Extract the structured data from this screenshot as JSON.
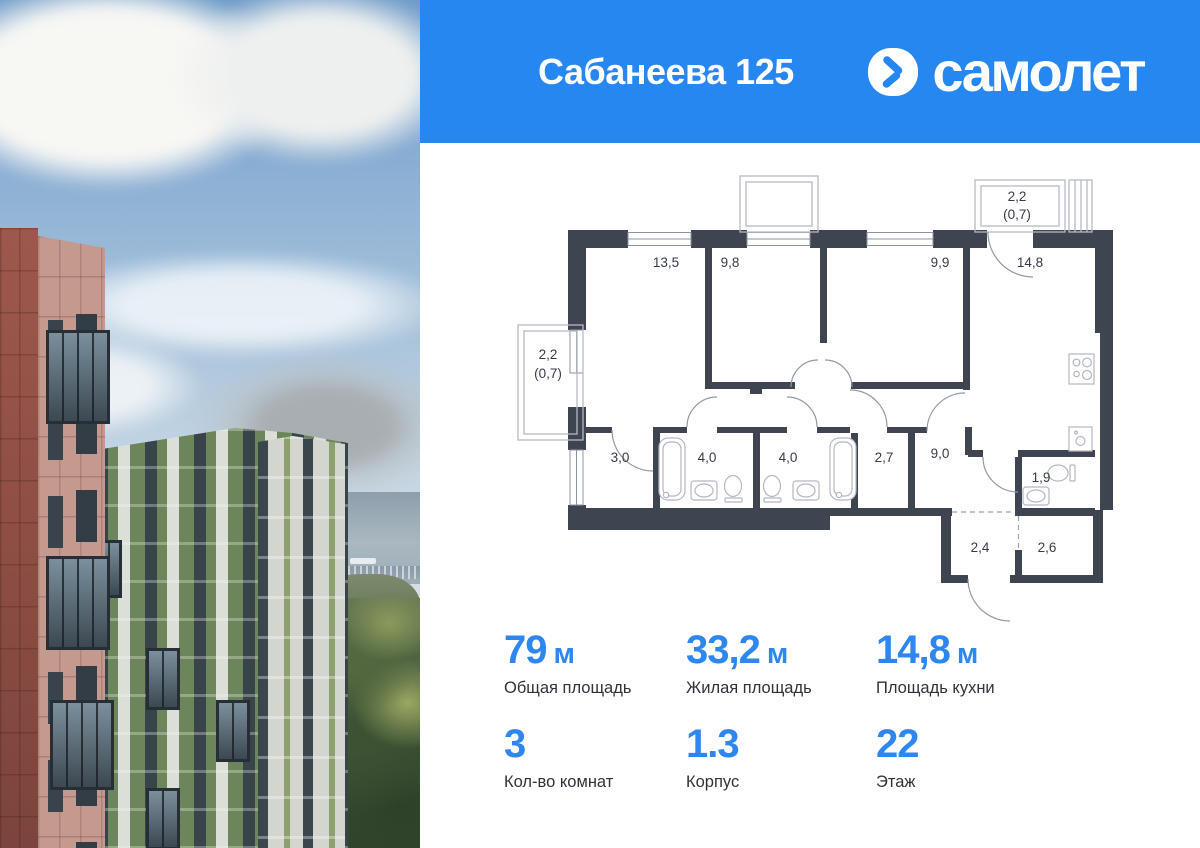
{
  "header": {
    "title": "Сабанеева 125",
    "brand_name": "самолет"
  },
  "floor_plan": {
    "rooms": [
      {
        "area": "13,5"
      },
      {
        "area": "9,8"
      },
      {
        "area": "9,9"
      },
      {
        "area": "14,8"
      },
      {
        "area": "3,0"
      },
      {
        "area": "4,0"
      },
      {
        "area": "4,0"
      },
      {
        "area": "2,7"
      },
      {
        "area": "9,0"
      },
      {
        "area": "1,9"
      },
      {
        "area": "2,4"
      },
      {
        "area": "2,6"
      }
    ],
    "balcony_left": {
      "area": "2,2",
      "area_reduced": "(0,7)"
    },
    "balcony_top": {
      "area": "2,2",
      "area_reduced": "(0,7)"
    }
  },
  "stats": {
    "items": [
      {
        "value": "79",
        "unit": "м",
        "label": "Общая площадь"
      },
      {
        "value": "33,2",
        "unit": "м",
        "label": "Жилая площадь"
      },
      {
        "value": "14,8",
        "unit": "м",
        "label": "Площадь кухни"
      },
      {
        "value": "3",
        "unit": "",
        "label": "Кол-во комнат"
      },
      {
        "value": "1.3",
        "unit": "",
        "label": "Корпус"
      },
      {
        "value": "22",
        "unit": "",
        "label": "Этаж"
      }
    ]
  },
  "colors": {
    "brand_blue": "#2787f0",
    "stat_blue": "#2e87f0",
    "wall_dark": "#3e4450",
    "label_text": "#363b47"
  }
}
